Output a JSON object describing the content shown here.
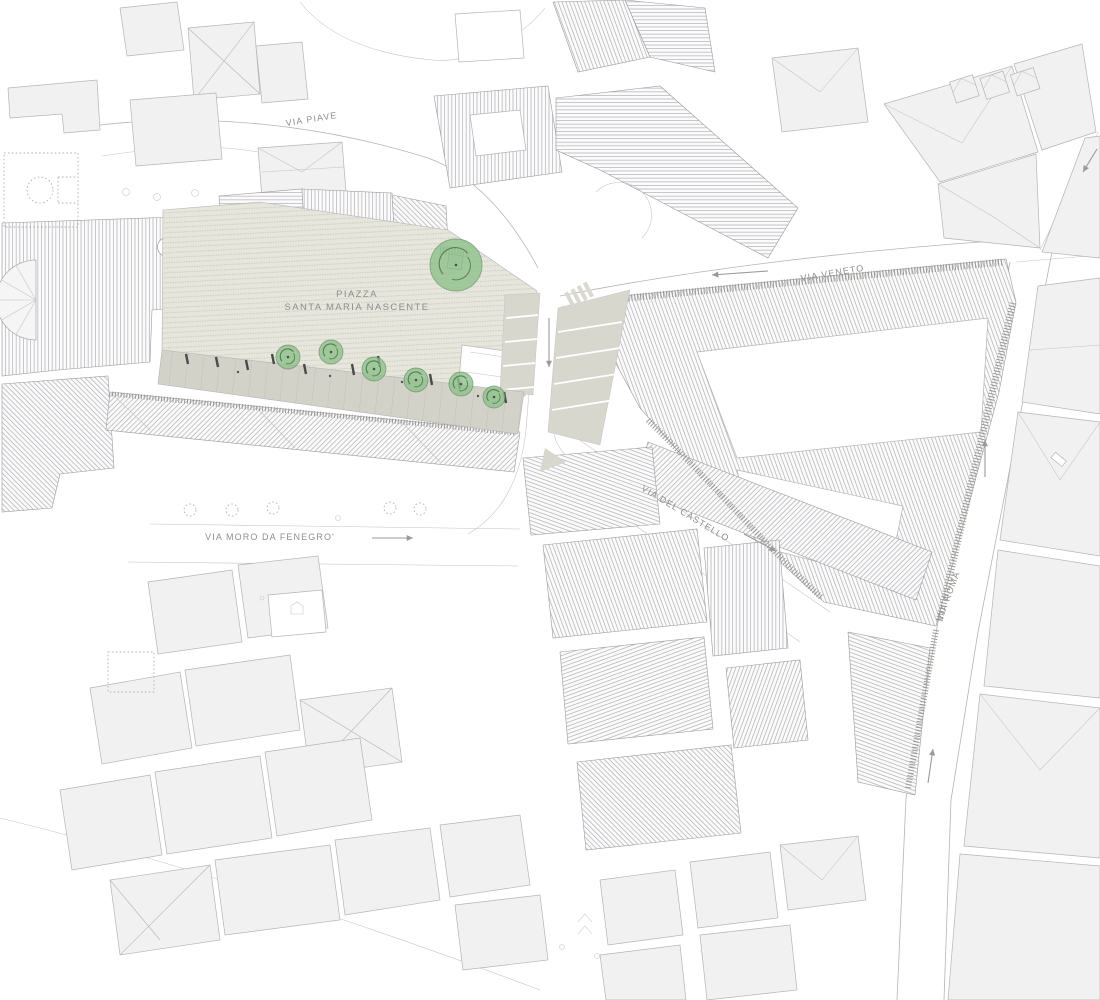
{
  "map": {
    "title": "Piazza Santa Maria Nascente site plan",
    "piazza": {
      "label_line1": "PIAZZA",
      "label_line2": "SANTA MARIA NASCENTE"
    },
    "streets": {
      "via_piave": "VIA PIAVE",
      "via_veneto": "VIA VENETO",
      "via_del_castello": "VIA DEL CASTELLO",
      "via_moro": "VIA MORO DA FENEGRO'",
      "via_roma": "VIA ROMA"
    },
    "icons": {
      "tree": "tree-icon",
      "direction_arrow": "direction-arrow-icon",
      "basketball_court": "basketball-court-icon",
      "church_apse": "church-apse-icon",
      "dome": "dome-circle-icon"
    },
    "colors": {
      "background": "#ffffff",
      "building_fill": "#f1f1f2",
      "building_stroke": "#b4b4b7",
      "roof_hatch": "#9b9b9f",
      "piazza_paving": "#e6e6dc",
      "piazza_dash": "#c8c8ba",
      "promenade_fill": "#d2d2c9",
      "sidewalk_fill": "#d7d7ce",
      "tree_fill": "#8fc08b",
      "tree_accent": "#4f7f53",
      "label_text": "#8e8e8e",
      "arrow": "#9a9a9a"
    },
    "tree_count": 7,
    "trees": [
      {
        "x": 456,
        "y": 265,
        "r": 26
      },
      {
        "x": 288,
        "y": 357,
        "r": 12
      },
      {
        "x": 331,
        "y": 352,
        "r": 12
      },
      {
        "x": 374,
        "y": 369,
        "r": 12
      },
      {
        "x": 416,
        "y": 380,
        "r": 12
      },
      {
        "x": 461,
        "y": 384,
        "r": 12
      },
      {
        "x": 494,
        "y": 397,
        "r": 11
      }
    ],
    "arrows": [
      {
        "x1": 768,
        "y1": 271,
        "x2": 712,
        "y2": 275
      },
      {
        "x1": 549,
        "y1": 318,
        "x2": 549,
        "y2": 367
      },
      {
        "x1": 744,
        "y1": 534,
        "x2": 776,
        "y2": 551
      },
      {
        "x1": 372,
        "y1": 538,
        "x2": 413,
        "y2": 538
      },
      {
        "x1": 985,
        "y1": 477,
        "x2": 985,
        "y2": 440
      },
      {
        "x1": 928,
        "y1": 783,
        "x2": 933,
        "y2": 749
      },
      {
        "x1": 1097,
        "y1": 149,
        "x2": 1083,
        "y2": 172
      }
    ]
  }
}
